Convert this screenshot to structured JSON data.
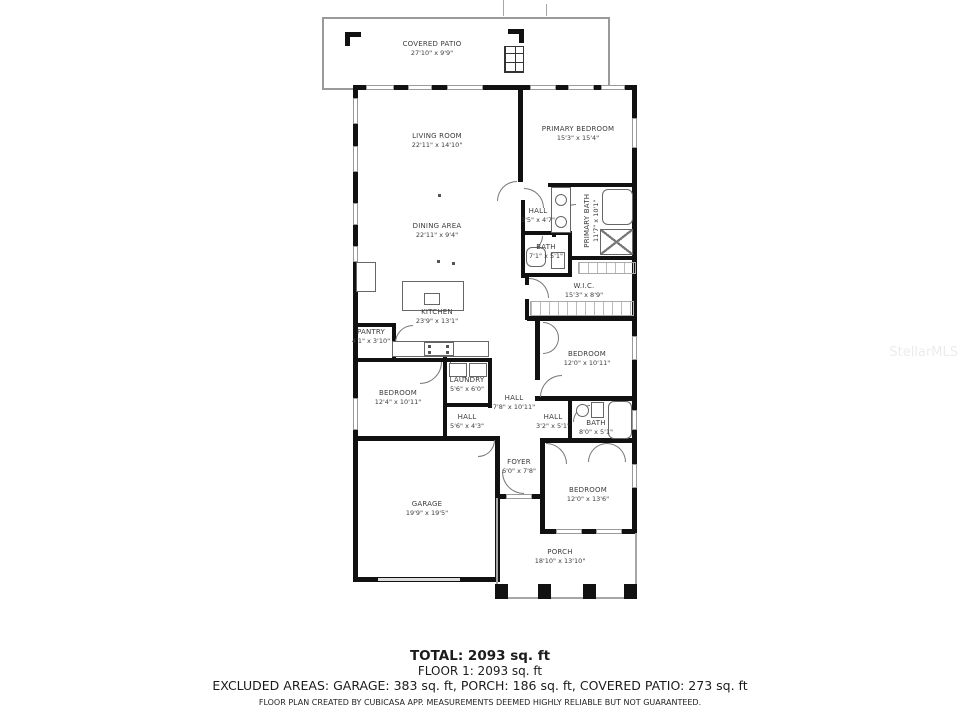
{
  "watermark": "StellarMLS",
  "footer": {
    "total": "TOTAL: 2093 sq. ft",
    "floor1": "FLOOR 1: 2093 sq. ft",
    "excluded": "EXCLUDED AREAS: GARAGE: 383 sq. ft, PORCH: 186 sq. ft, COVERED PATIO: 273 sq. ft",
    "disclaimer": "FLOOR PLAN CREATED BY CUBICASA APP. MEASUREMENTS DEEMED HIGHLY RELIABLE BUT NOT GUARANTEED."
  },
  "colors": {
    "wall": "#111111",
    "window": "#9a9a9a",
    "label": "#3c3c3c"
  },
  "rooms": {
    "covered_patio": {
      "name": "COVERED PATIO",
      "dims": "27'10\" x 9'9\""
    },
    "living": {
      "name": "LIVING ROOM",
      "dims": "22'11\" x 14'10\""
    },
    "primary_bedroom": {
      "name": "PRIMARY BEDROOM",
      "dims": "15'3\" x 15'4\""
    },
    "primary_bath": {
      "name": "PRIMARY BATH",
      "dims": "11'7\" x 10'1\""
    },
    "hall_primary": {
      "name": "HALL",
      "dims": "3'5\" x 4'7\""
    },
    "bath_small": {
      "name": "BATH",
      "dims": "7'1\" x 5'1\""
    },
    "wic": {
      "name": "W.I.C.",
      "dims": "15'3\" x 8'9\""
    },
    "dining": {
      "name": "DINING AREA",
      "dims": "22'11\" x 9'4\""
    },
    "kitchen": {
      "name": "KITCHEN",
      "dims": "23'9\" x 13'1\""
    },
    "pantry": {
      "name": "PANTRY",
      "dims": "4'1\" x 3'10\""
    },
    "bedroom_left": {
      "name": "BEDROOM",
      "dims": "12'4\" x 10'11\""
    },
    "laundry": {
      "name": "LAUNDRY",
      "dims": "5'6\" x 6'0\""
    },
    "hall_center": {
      "name": "HALL",
      "dims": "7'8\" x 10'11\""
    },
    "hall_left": {
      "name": "HALL",
      "dims": "5'6\" x 4'3\""
    },
    "hall_right": {
      "name": "HALL",
      "dims": "3'2\" x 5'1\""
    },
    "bath_bottom": {
      "name": "BATH",
      "dims": "8'0\" x 5'1\""
    },
    "bedroom_mid": {
      "name": "BEDROOM",
      "dims": "12'0\" x 10'11\""
    },
    "foyer": {
      "name": "FOYER",
      "dims": "6'0\" x 7'8\""
    },
    "garage": {
      "name": "GARAGE",
      "dims": "19'9\" x 19'5\""
    },
    "bedroom_bottom": {
      "name": "BEDROOM",
      "dims": "12'0\" x 13'6\""
    },
    "porch": {
      "name": "PORCH",
      "dims": "18'10\" x 13'10\""
    }
  }
}
